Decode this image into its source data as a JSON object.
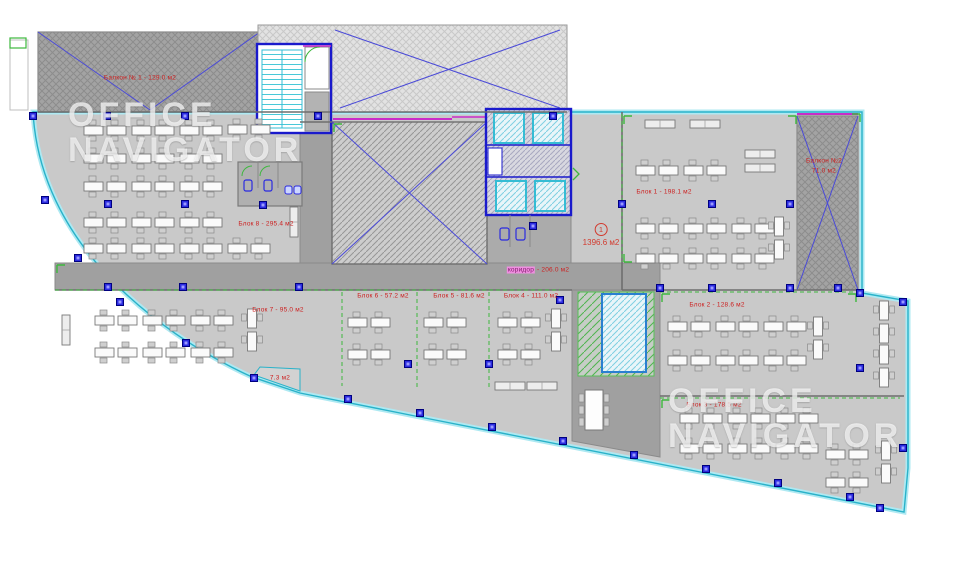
{
  "plan": {
    "type": "office-floor-plan",
    "watermark": {
      "line1": "OFFICE",
      "line2": "NAVIGATOR"
    },
    "labels": {
      "balcony1": "Балкон № 1 - 129.0 м2",
      "balcony2_name": "Балкон №2",
      "balcony2_area": "71.0 м2",
      "block1": "Блок 1 - 198.1 м2",
      "block2": "Блок 2 - 128.6 м2",
      "block3": "Блок 3 - 178.5 м2",
      "block4": "Блок 4 - 111.0 м2",
      "block5": "Блок 5 - 81.6 м2",
      "block6": "Блок 6 - 57.2 м2",
      "block7": "Блок 7 - 95.0 м2",
      "block8": "Блок 8 - 295.4 м2",
      "corridor_name": "коридор",
      "corridor_area": "- 206.0 м2",
      "room_small": "7.3 м2",
      "total_index": "1",
      "total_area": "1396.6 м2"
    },
    "colors": {
      "floor": "#c9c9c9",
      "corridor": "#a0a0a0",
      "outline_cyan": "#29b2c9",
      "wall_blue": "#1a1acc",
      "elevator_cyan": "#35bcd4",
      "green": "#3db83d",
      "magenta": "#c92cc9",
      "label_red": "#cc2020",
      "marker_blue": "#2b2be0"
    }
  }
}
